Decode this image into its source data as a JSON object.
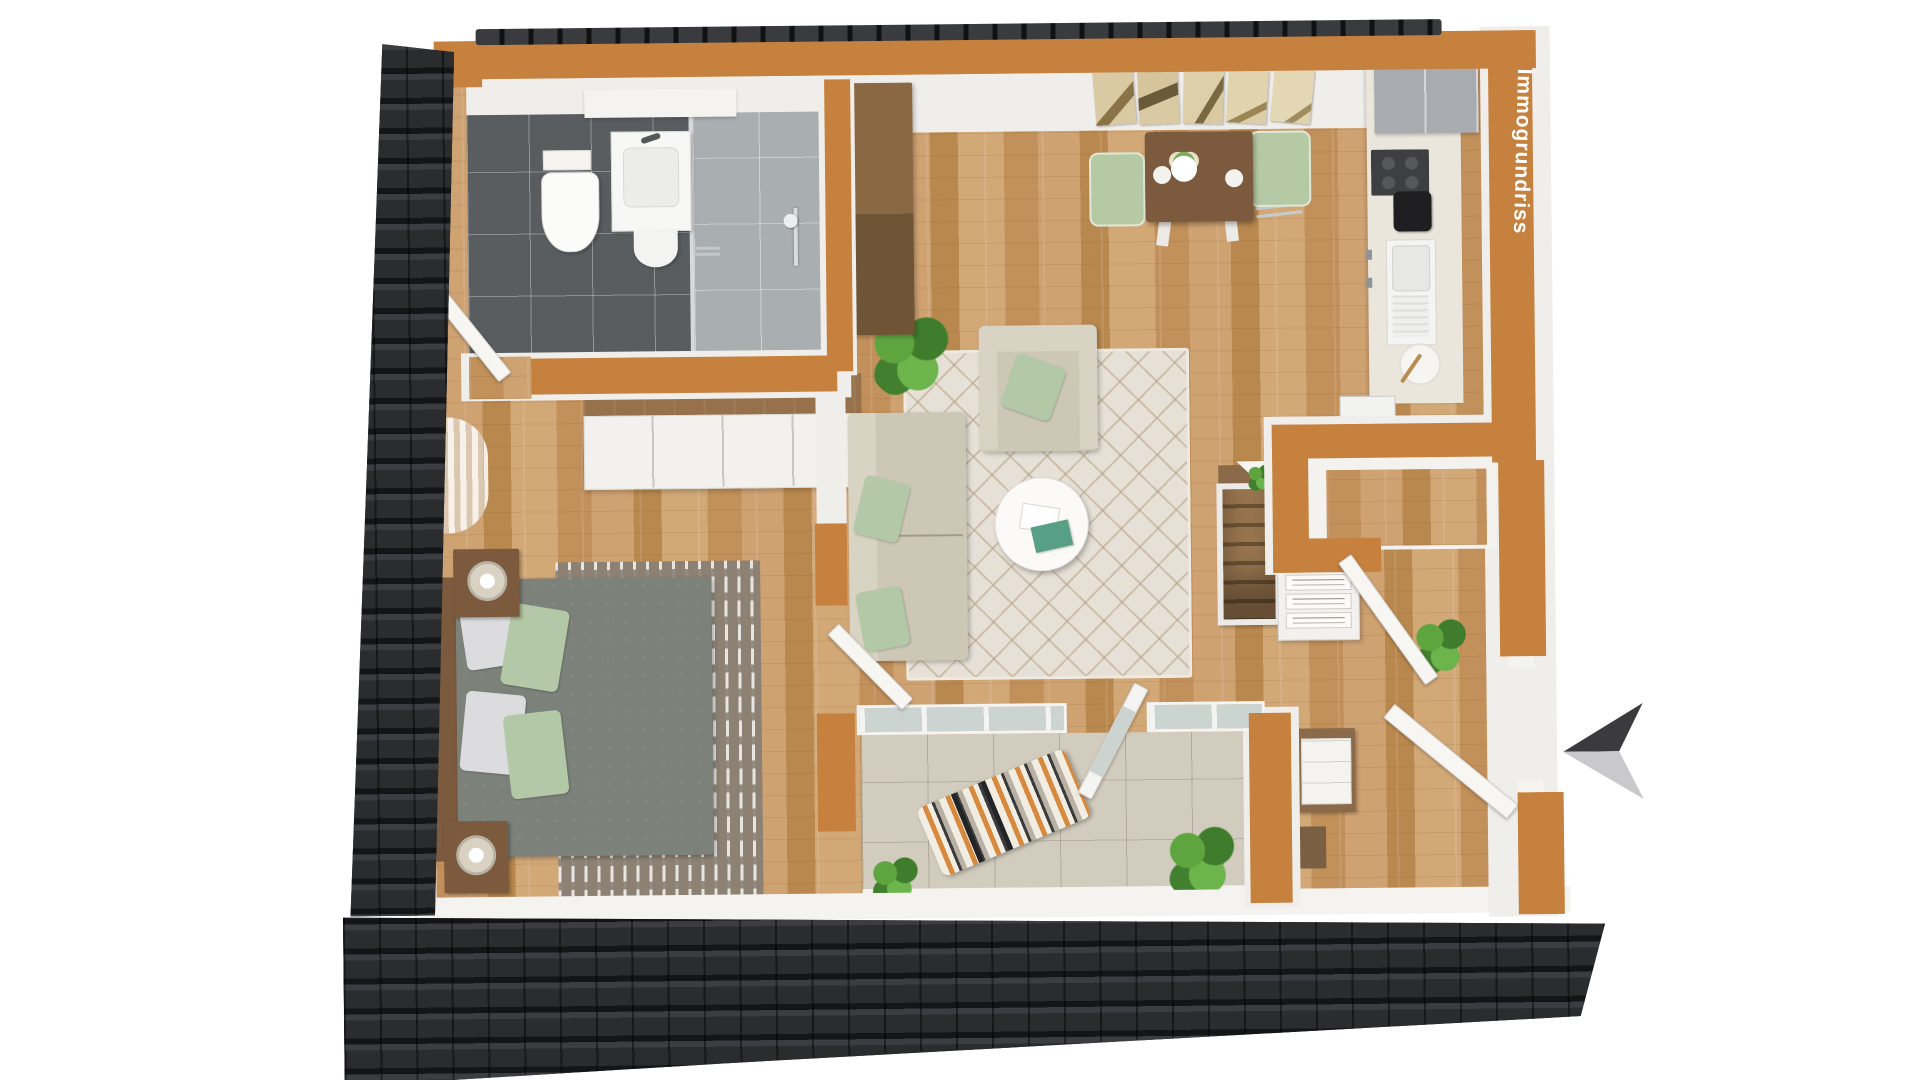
{
  "watermark": {
    "label": "Immogrundriss"
  },
  "entrance_arrow": {
    "direction": "left"
  },
  "palette": {
    "wall_orange": "#c6813f",
    "roof_dark": "#2b2c2e",
    "wood_floor": "#c79a67",
    "wood_dark": "#7b5a3e",
    "wood_mid": "#96714b",
    "bath_tile": "#595d5f",
    "shower_tile": "#a9aeb0",
    "rug_cream": "#e6e0d6",
    "rug_bedroom": "#8c8173",
    "bed_gray": "#7c817a",
    "sofa_beige": "#cdc7b6",
    "pillow_green": "#b3c8a6",
    "chair_green": "#b5c9a4",
    "kitchen_gray": "#a8acb0",
    "counter_cream": "#eae6db",
    "balcony_tile": "#d2ccbe",
    "door_white": "#f4f3f0",
    "plant_green": "#55983a",
    "arrow_dark": "#3b3b3e",
    "arrow_light": "#c9c9cc"
  }
}
